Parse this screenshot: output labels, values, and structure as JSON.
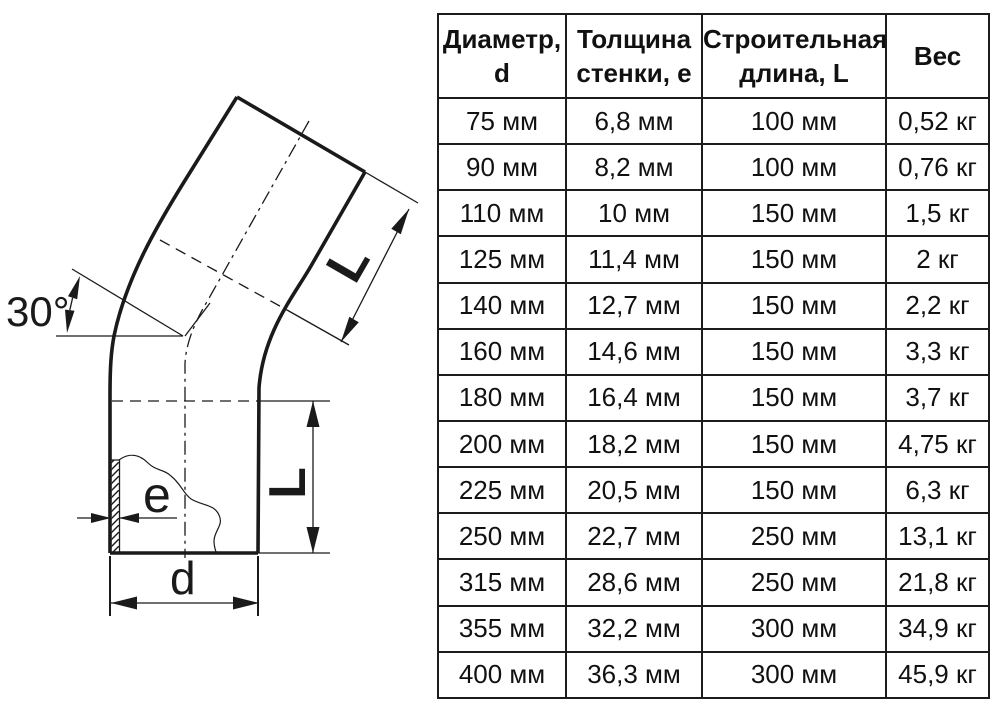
{
  "diagram": {
    "angle_label": "30°",
    "length_label_upper": "L",
    "length_label_lower": "L",
    "wall_thickness_label": "e",
    "diameter_label": "d",
    "line_color": "#1a1a1a"
  },
  "table": {
    "headers": [
      "Диаметр,\nd",
      "Толщина\nстенки, e",
      "Строительная\nдлина, L",
      "Вес"
    ],
    "rows": [
      [
        "75 мм",
        "6,8 мм",
        "100 мм",
        "0,52 кг"
      ],
      [
        "90 мм",
        "8,2 мм",
        "100 мм",
        "0,76 кг"
      ],
      [
        "110 мм",
        "10 мм",
        "150 мм",
        "1,5 кг"
      ],
      [
        "125 мм",
        "11,4 мм",
        "150 мм",
        "2 кг"
      ],
      [
        "140 мм",
        "12,7 мм",
        "150 мм",
        "2,2 кг"
      ],
      [
        "160 мм",
        "14,6 мм",
        "150 мм",
        "3,3 кг"
      ],
      [
        "180 мм",
        "16,4 мм",
        "150 мм",
        "3,7 кг"
      ],
      [
        "200 мм",
        "18,2 мм",
        "150 мм",
        "4,75 кг"
      ],
      [
        "225 мм",
        "20,5 мм",
        "150 мм",
        "6,3 кг"
      ],
      [
        "250 мм",
        "22,7 мм",
        "250 мм",
        "13,1 кг"
      ],
      [
        "315 мм",
        "28,6 мм",
        "250 мм",
        "21,8 кг"
      ],
      [
        "355 мм",
        "32,2 мм",
        "300 мм",
        "34,9 кг"
      ],
      [
        "400 мм",
        "36,3 мм",
        "300 мм",
        "45,9 кг"
      ]
    ]
  }
}
